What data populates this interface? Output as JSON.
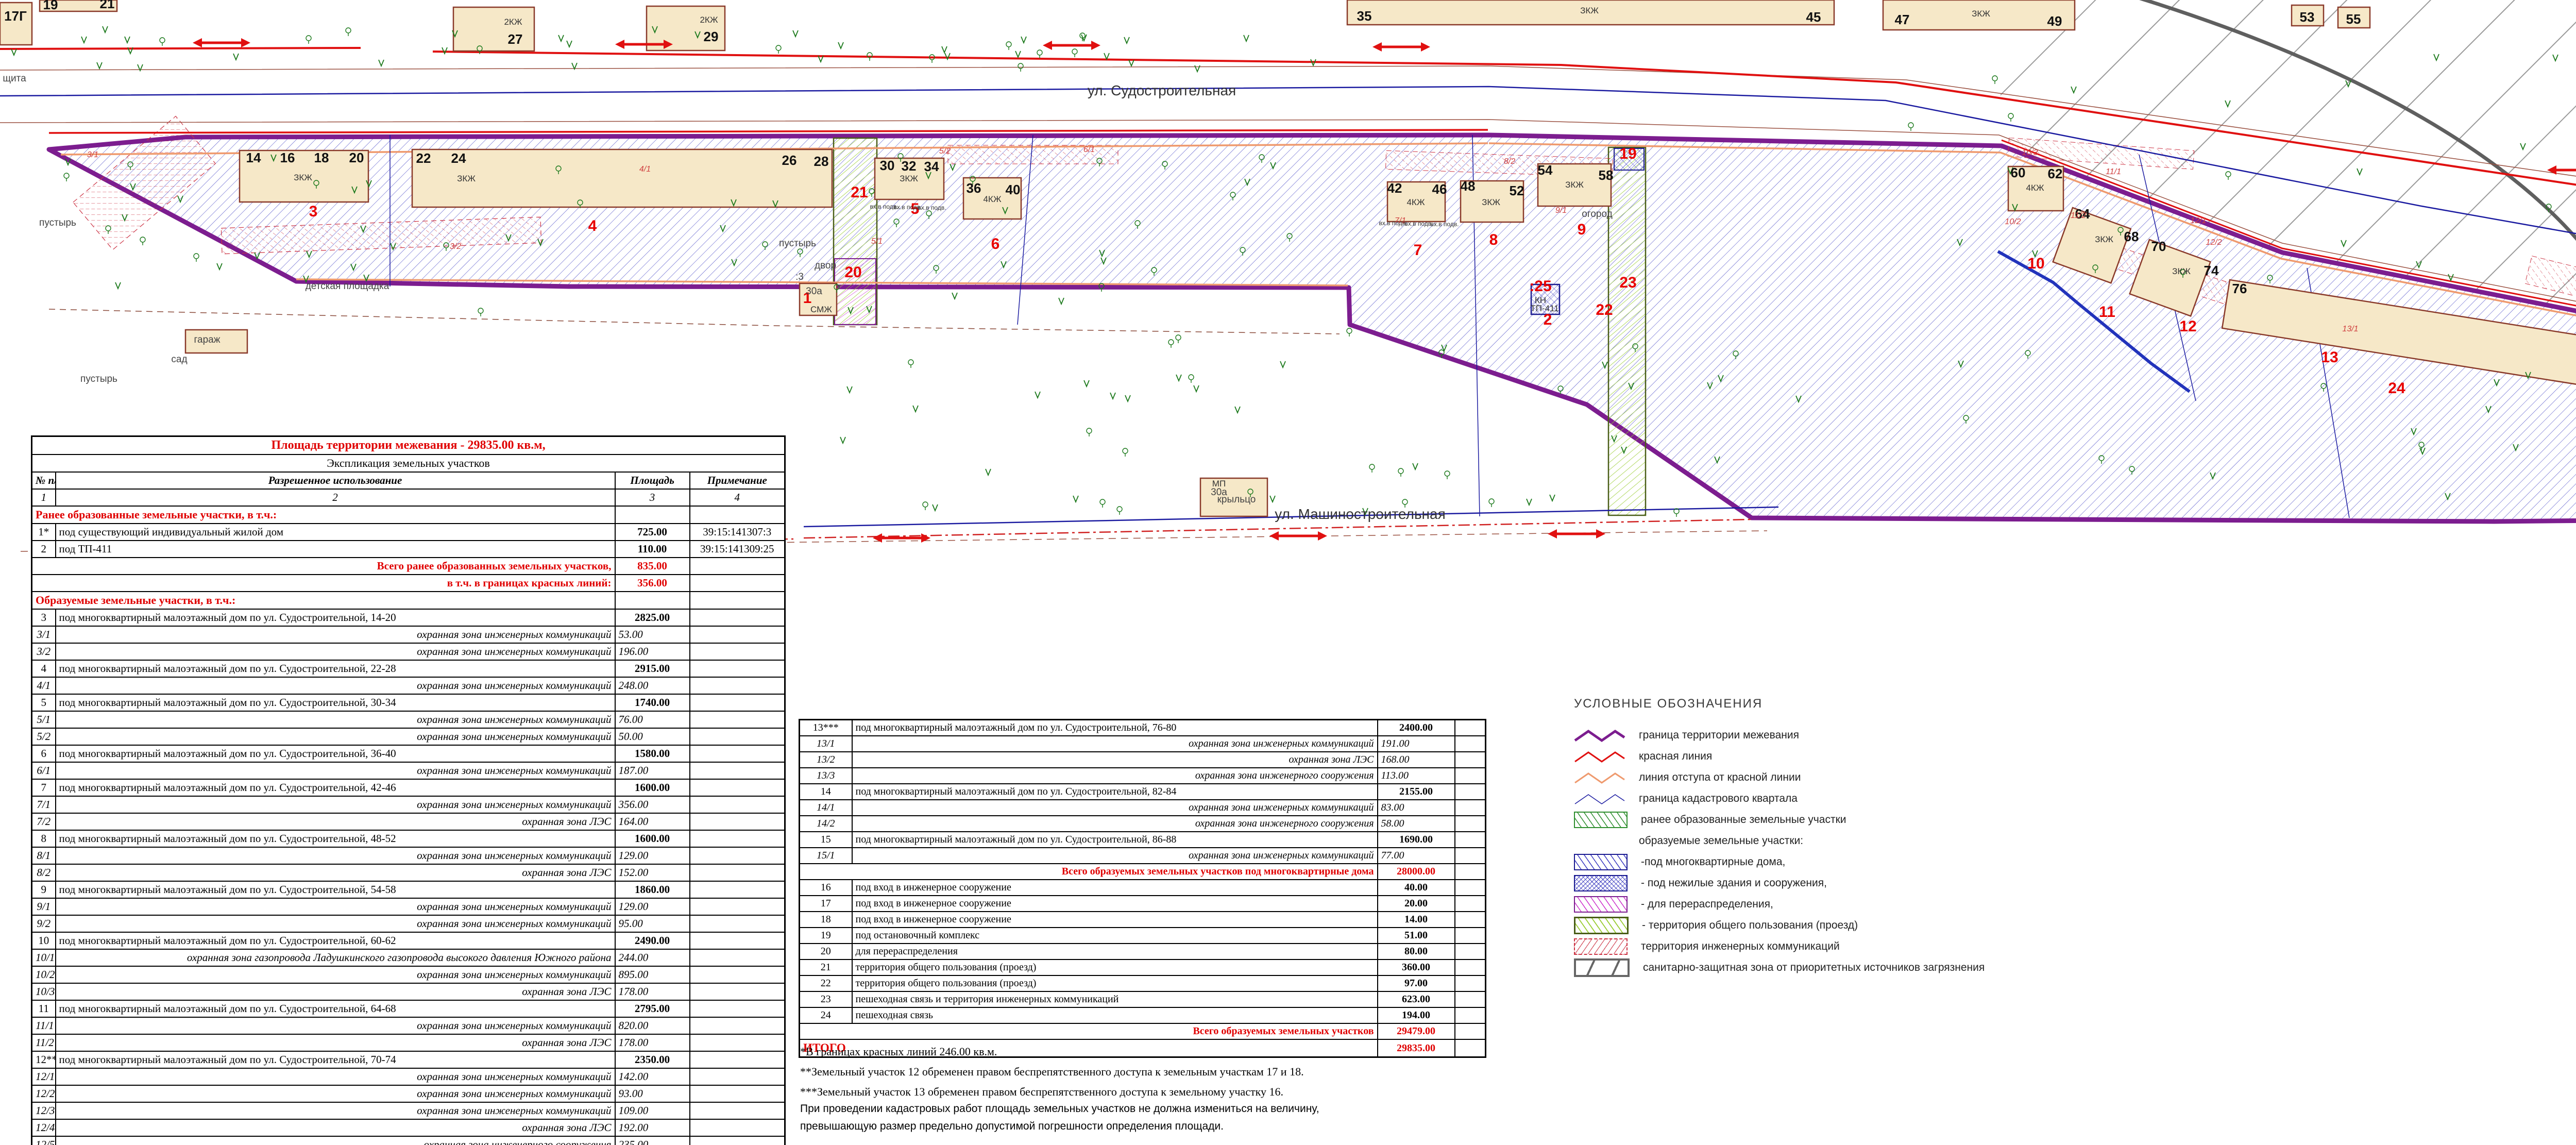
{
  "doc": {
    "kind": "план межевания территории"
  },
  "map": {
    "streets": {
      "top": "ул. Судостроительная",
      "mid": "ул. Машиностроительная"
    },
    "labels": [
      "ул. Судостроительная",
      "ул. Машиностроительная",
      "17Г",
      "19",
      "21",
      "27",
      "29",
      "35",
      "45",
      "47",
      "49",
      "53",
      "55",
      "77",
      "79",
      "81",
      "83",
      "14",
      "16",
      "18",
      "20",
      "22",
      "24",
      "26",
      "28",
      "30",
      "32",
      "34",
      "36",
      "40",
      "42",
      "46",
      "48",
      "52",
      "54",
      "58",
      "60",
      "62",
      "64",
      "68",
      "70",
      "74",
      "76",
      "80",
      "82",
      "84",
      "86",
      "88",
      "2КЖ",
      "2КЖ",
      "ЗКЖ",
      "ЗКЖ",
      "4КЖ",
      "ЗКЖ",
      "ЗКЖ",
      "ЗКЖ",
      "4КЖ",
      "4КЖ",
      "ЗКЖ",
      "ЗКЖ",
      "4КЖ",
      "ЗКЖ",
      "ЗКЖ",
      "2КЖ",
      "СМЖ",
      "КН",
      "МН",
      "МН",
      "МП",
      "ТП-411",
      "1",
      "2",
      "3",
      "4",
      "5",
      "6",
      "7",
      "8",
      "9",
      "10",
      "11",
      "12",
      "13",
      "14",
      "15",
      "16",
      "19",
      "20",
      "21",
      "22",
      "23",
      "24",
      ":25",
      "3/1",
      "3/2",
      "4/1",
      "5/1",
      "5/2",
      "6/1",
      "7/1",
      "8/2",
      "9/1",
      "10/2",
      "10/3",
      "11/1",
      "11/2",
      "12/1",
      "12/2",
      "13/1",
      "14/1",
      "15/1",
      "пустырь",
      "пустырь",
      "пустырь",
      "двор",
      "детская площадка",
      "дет.площадка",
      "огород",
      "щита",
      "гараж",
      "сад",
      "крыльцо",
      ":3",
      "30а",
      "30а",
      "вх.в подв.",
      "вх.в подв.",
      "вх.в подв.",
      "вх.в подв.",
      "вх.в подв.",
      "вх.в подв."
    ],
    "colors": {
      "boundary": "#7c1d8f",
      "red_line": "#e01010",
      "setback_line": "#ef9a6e",
      "cadastral_line": "#1a1aa0",
      "building_fill": "#f6e8c8",
      "building_stroke": "#8a3a2a",
      "parcel_number_red": "#e80000",
      "sanitary_gray": "#666666"
    }
  },
  "tables": {
    "left": {
      "rows": [
        {
          "k": "title",
          "c": [
            "Площадь территории межевания   - 29835.00 кв.м,"
          ]
        },
        {
          "k": "sub",
          "c": [
            "Экспликация земельных участков"
          ]
        },
        {
          "k": "cols",
          "c": [
            "№ п/п",
            "Разрешенное использование",
            "Площадь",
            "Примечание"
          ]
        },
        {
          "k": "nums",
          "c": [
            "1",
            "2",
            "3",
            "4"
          ]
        },
        {
          "k": "sec",
          "c": [
            "Ранее образованные земельные участки, в т.ч.:"
          ]
        },
        {
          "k": "item",
          "c": [
            "1*",
            "под существующий индивидуальный жилой дом",
            "725.00",
            "39:15:141307:3"
          ]
        },
        {
          "k": "item",
          "c": [
            "2",
            "под ТП-411",
            "110.00",
            "39:15:141309:25"
          ]
        },
        {
          "k": "tot",
          "c": [
            "Всего ранее образованных земельных участков,",
            "835.00",
            ""
          ]
        },
        {
          "k": "tot",
          "c": [
            "в т.ч. в границах красных линий:",
            "356.00",
            ""
          ]
        },
        {
          "k": "sec",
          "c": [
            "Образуемые земельные участки, в т.ч.:"
          ]
        },
        {
          "k": "item",
          "c": [
            "3",
            "под многоквартирный малоэтажный дом по ул. Судостроительной, 14-20",
            "2825.00",
            ""
          ]
        },
        {
          "k": "subr",
          "c": [
            "3/1",
            "охранная зона инженерных коммуникаций",
            "53.00",
            ""
          ]
        },
        {
          "k": "subr",
          "c": [
            "3/2",
            "охранная зона инженерных коммуникаций",
            "196.00",
            ""
          ]
        },
        {
          "k": "item",
          "c": [
            "4",
            "под многоквартирный малоэтажный дом по ул. Судостроительной, 22-28",
            "2915.00",
            ""
          ]
        },
        {
          "k": "subr",
          "c": [
            "4/1",
            "охранная зона инженерных коммуникаций",
            "248.00",
            ""
          ]
        },
        {
          "k": "item",
          "c": [
            "5",
            "под многоквартирный малоэтажный дом по ул. Судостроительной, 30-34",
            "1740.00",
            ""
          ]
        },
        {
          "k": "subr",
          "c": [
            "5/1",
            "охранная зона инженерных коммуникаций",
            "76.00",
            ""
          ]
        },
        {
          "k": "subr",
          "c": [
            "5/2",
            "охранная зона инженерных коммуникаций",
            "50.00",
            ""
          ]
        },
        {
          "k": "item",
          "c": [
            "6",
            "под многоквартирный малоэтажный дом по ул. Судостроительной, 36-40",
            "1580.00",
            ""
          ]
        },
        {
          "k": "subr",
          "c": [
            "6/1",
            "охранная зона инженерных коммуникаций",
            "187.00",
            ""
          ]
        },
        {
          "k": "item",
          "c": [
            "7",
            "под многоквартирный малоэтажный дом по ул. Судостроительной, 42-46",
            "1600.00",
            ""
          ]
        },
        {
          "k": "subr",
          "c": [
            "7/1",
            "охранная зона инженерных коммуникаций",
            "356.00",
            ""
          ]
        },
        {
          "k": "subr",
          "c": [
            "7/2",
            "охранная зона ЛЭС",
            "164.00",
            ""
          ]
        },
        {
          "k": "item",
          "c": [
            "8",
            "под многоквартирный малоэтажный дом по ул. Судостроительной, 48-52",
            "1600.00",
            ""
          ]
        },
        {
          "k": "subr",
          "c": [
            "8/1",
            "охранная зона инженерных коммуникаций",
            "129.00",
            ""
          ]
        },
        {
          "k": "subr",
          "c": [
            "8/2",
            "охранная зона ЛЭС",
            "152.00",
            ""
          ]
        },
        {
          "k": "item",
          "c": [
            "9",
            "под многоквартирный малоэтажный дом по ул. Судостроительной, 54-58",
            "1860.00",
            ""
          ]
        },
        {
          "k": "subr",
          "c": [
            "9/1",
            "охранная зона инженерных коммуникаций",
            "129.00",
            ""
          ]
        },
        {
          "k": "subr",
          "c": [
            "9/2",
            "охранная зона инженерных коммуникаций",
            "95.00",
            ""
          ]
        },
        {
          "k": "item",
          "c": [
            "10",
            "под многоквартирный малоэтажный дом по ул. Судостроительной, 60-62",
            "2490.00",
            ""
          ]
        },
        {
          "k": "subr",
          "c": [
            "10/1",
            "охранная зона газопровода Ладушкинского газопровода высокого давления Южного района",
            "244.00",
            ""
          ]
        },
        {
          "k": "subr",
          "c": [
            "10/2",
            "охранная зона инженерных коммуникаций",
            "895.00",
            ""
          ]
        },
        {
          "k": "subr",
          "c": [
            "10/3",
            "охранная зона ЛЭС",
            "178.00",
            ""
          ]
        },
        {
          "k": "item",
          "c": [
            "11",
            "под многоквартирный малоэтажный дом по ул. Судостроительной, 64-68",
            "2795.00",
            ""
          ]
        },
        {
          "k": "subr",
          "c": [
            "11/1",
            "охранная зона инженерных коммуникаций",
            "820.00",
            ""
          ]
        },
        {
          "k": "subr",
          "c": [
            "11/2",
            "охранная зона ЛЭС",
            "178.00",
            ""
          ]
        },
        {
          "k": "item",
          "c": [
            "12**",
            "под многоквартирный малоэтажный дом по ул. Судостроительной, 70-74",
            "2350.00",
            ""
          ]
        },
        {
          "k": "subr",
          "c": [
            "12/1",
            "охранная зона инженерных коммуникаций",
            "142.00",
            ""
          ]
        },
        {
          "k": "subr",
          "c": [
            "12/2",
            "охранная зона инженерных коммуникаций",
            "93.00",
            ""
          ]
        },
        {
          "k": "subr",
          "c": [
            "12/3",
            "охранная зона инженерных коммуникаций",
            "109.00",
            ""
          ]
        },
        {
          "k": "subr",
          "c": [
            "12/4",
            "охранная зона ЛЭС",
            "192.00",
            ""
          ]
        },
        {
          "k": "subr",
          "c": [
            "12/5",
            "охранная зона инженерного сооружения",
            "235.00",
            ""
          ]
        }
      ]
    },
    "right": {
      "rows": [
        {
          "k": "item",
          "c": [
            "13***",
            "под многоквартирный малоэтажный дом по ул. Судостроительной, 76-80",
            "2400.00",
            ""
          ]
        },
        {
          "k": "subr",
          "c": [
            "13/1",
            "охранная зона инженерных коммуникаций",
            "191.00",
            ""
          ]
        },
        {
          "k": "subr",
          "c": [
            "13/2",
            "охранная зона ЛЭС",
            "168.00",
            ""
          ]
        },
        {
          "k": "subr",
          "c": [
            "13/3",
            "охранная зона инженерного сооружения",
            "113.00",
            ""
          ]
        },
        {
          "k": "item",
          "c": [
            "14",
            "под многоквартирный малоэтажный дом по ул. Судостроительной, 82-84",
            "2155.00",
            ""
          ]
        },
        {
          "k": "subr",
          "c": [
            "14/1",
            "охранная зона инженерных коммуникаций",
            "83.00",
            ""
          ]
        },
        {
          "k": "subr",
          "c": [
            "14/2",
            "охранная зона инженерного сооружения",
            "58.00",
            ""
          ]
        },
        {
          "k": "item",
          "c": [
            "15",
            "под многоквартирный малоэтажный дом по ул. Судостроительной, 86-88",
            "1690.00",
            ""
          ]
        },
        {
          "k": "subr",
          "c": [
            "15/1",
            "охранная зона инженерных коммуникаций",
            "77.00",
            ""
          ]
        },
        {
          "k": "tot",
          "c": [
            "Всего образуемых земельных участков под многоквартирные дома",
            "28000.00",
            ""
          ]
        },
        {
          "k": "item",
          "c": [
            "16",
            "под вход в инженерное сооружение",
            "40.00",
            ""
          ]
        },
        {
          "k": "item",
          "c": [
            "17",
            "под вход в инженерное сооружение",
            "20.00",
            ""
          ]
        },
        {
          "k": "item",
          "c": [
            "18",
            "под вход в инженерное сооружение",
            "14.00",
            ""
          ]
        },
        {
          "k": "item",
          "c": [
            "19",
            "под остановочный комплекс",
            "51.00",
            ""
          ]
        },
        {
          "k": "item",
          "c": [
            "20",
            "для перераспределения",
            "80.00",
            ""
          ]
        },
        {
          "k": "item",
          "c": [
            "21",
            "территория общего пользования (проезд)",
            "360.00",
            ""
          ]
        },
        {
          "k": "item",
          "c": [
            "22",
            "территория общего пользования (проезд)",
            "97.00",
            ""
          ]
        },
        {
          "k": "item",
          "c": [
            "23",
            "пешеходная связь и территория инженерных коммуникаций",
            "623.00",
            ""
          ]
        },
        {
          "k": "item",
          "c": [
            "24",
            "пешеходная связь",
            "194.00",
            ""
          ]
        },
        {
          "k": "tot",
          "c": [
            "Всего образуемых земельных участков",
            "29479.00",
            ""
          ]
        },
        {
          "k": "grand",
          "c": [
            "ИТОГО",
            "29835.00",
            ""
          ]
        }
      ]
    }
  },
  "legend": {
    "title": "УСЛОВНЫЕ   ОБОЗНАЧЕНИЯ",
    "items": [
      {
        "swatch": "zig-purple",
        "label": "граница территории межевания"
      },
      {
        "swatch": "zig-red",
        "label": "красная линия"
      },
      {
        "swatch": "zig-salmon",
        "label": "линия отступа от красной линии"
      },
      {
        "swatch": "zig-navy",
        "label": "граница кадастрового квартала"
      },
      {
        "swatch": "hatch-green",
        "label": "ранее образованные земельные участки"
      },
      {
        "swatch": "none",
        "label": "образуемые земельные участки:"
      },
      {
        "swatch": "hatch-navy",
        "label": "-под многоквартирные дома,"
      },
      {
        "swatch": "cross-navy",
        "label": "- под нежилые здания и сооружения,"
      },
      {
        "swatch": "hatch-magenta",
        "label": "- для перераспределения,"
      },
      {
        "swatch": "hatch-yellowgreen",
        "label": "- территория общего пользования (проезд)"
      },
      {
        "swatch": "hatch-reddash",
        "label": "территория  инженерных коммуникаций"
      },
      {
        "swatch": "gray-band",
        "label": "санитарно-защитная зона от приоритетных источников загрязнения"
      }
    ]
  },
  "footnotes": [
    "*В границах красных линий 246.00 кв.м.",
    "**Земельный участок 12 обременен правом беспрепятственного доступа к земельным участкам 17 и 18.",
    "***Земельный участок 13 обременен правом беспрепятственного доступа к земельному участку 16."
  ],
  "paragraph": [
    "При проведении кадастровых работ площадь земельных участков не должна измениться на величину,",
    "превышающую размер предельно допустимой погрешности определения площади."
  ]
}
